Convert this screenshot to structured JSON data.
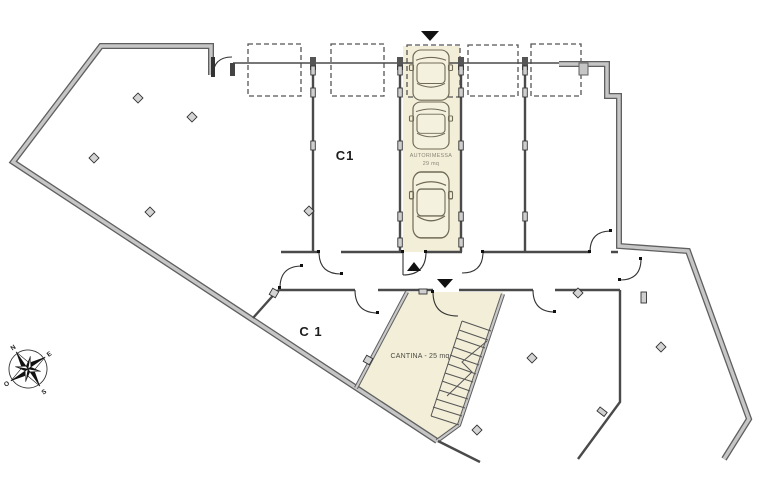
{
  "plan": {
    "labels": {
      "unit_garage": "C1",
      "unit_cellar": "C 1",
      "autorimessa": "AUTORIMESSA",
      "autorimessa_area": "29 mq",
      "cantina": "CANTINA - 25 mq"
    },
    "compass": {
      "n": "N",
      "e": "E",
      "s": "S",
      "o": "O"
    },
    "colors": {
      "highlight": "#f2eed8",
      "wall_fill": "#c6c6c6",
      "wall_edge": "#5f5f5f",
      "line": "#4a4a4a"
    },
    "counts": {
      "parking_outlines": 5,
      "cars": 3
    }
  }
}
